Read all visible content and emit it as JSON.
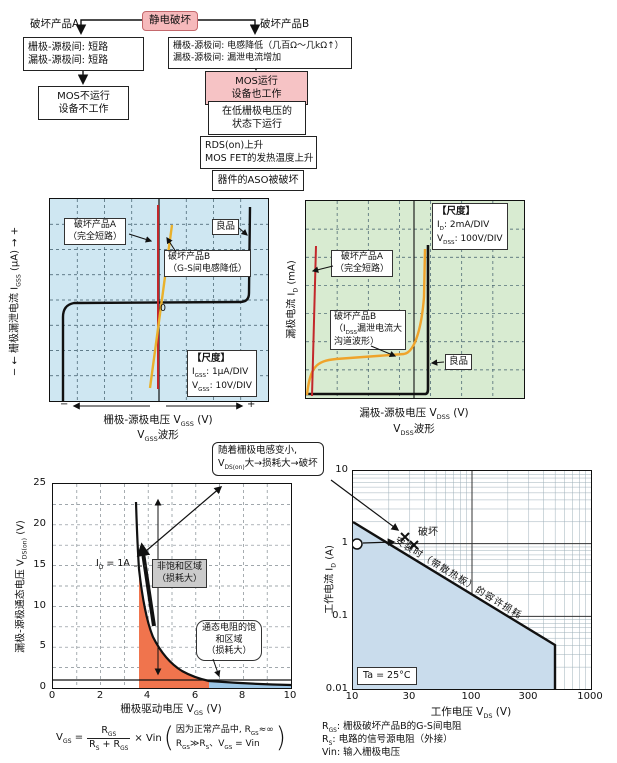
{
  "flowchart": {
    "trigger": "静电破坏",
    "branch_a": {
      "label": "破坏产品A",
      "box1": [
        "栅极-源极间: 短路",
        "漏极-源极间: 短路"
      ],
      "box2": [
        "MOS不运行",
        "设备不工作"
      ]
    },
    "branch_b": {
      "label": "破坏产品B",
      "box1": [
        "栅极-源极间: 电感降低（几百Ω～几kΩ↑）",
        "漏极-源极间: 漏泄电流增加"
      ],
      "box2": [
        "MOS运行",
        "设备也工作"
      ],
      "box3": [
        "在低栅极电压的",
        "状态下运行"
      ],
      "box4": [
        "RDS(on)上升",
        "MOS FET的发热温度上升"
      ],
      "box5": "器件的ASO被破坏"
    }
  },
  "gate_chart": {
    "y_label": {
      "minus": "− ←",
      "pre": "  栅极漏泄电流 I",
      "sub": "GSS",
      "unit": " (μA)  ",
      "plus": "→ +"
    },
    "x_label": {
      "pre": "栅极-源极电压 V",
      "sub": "GSS",
      "unit": " (V)"
    },
    "x_minus": "−",
    "x_plus": "+",
    "waveform": {
      "pre": "V",
      "sub": "GSS",
      "suffix": "波形"
    },
    "zero": "0",
    "product_a": [
      "破坏产品A",
      "（完全短路）"
    ],
    "product_b": [
      "破坏产品B",
      "（G-S间电感降低）"
    ],
    "good": "良品",
    "scale": {
      "title": "【尺度】",
      "r1a": "I",
      "r1s": "GSS",
      "r1b": ": 1μA/DIV",
      "r2a": "V",
      "r2s": "GSS",
      "r2b": ": 10V/DIV"
    }
  },
  "drain_chart": {
    "y_label": {
      "pre": "漏极电流 I",
      "sub": "D",
      "unit": " (mA)"
    },
    "x_label": {
      "pre": "漏极-源极电压 V",
      "sub": "DSS",
      "unit": " (V)"
    },
    "waveform": {
      "pre": "V",
      "sub": "DSS",
      "suffix": "波形"
    },
    "product_a": [
      "破坏产品A",
      "（完全短路）"
    ],
    "product_b": {
      "l1": "破坏产品B",
      "l2a": "（I",
      "l2s": "DSS",
      "l2b": "漏泄电流大",
      "l3": "沟道波形）"
    },
    "good": "良品",
    "scale": {
      "title": "【尺度】",
      "r1a": "I",
      "r1s": "D",
      "r1b": ": 2mA/DIV",
      "r2a": "V",
      "r2s": "DSS",
      "r2b": ": 100V/DIV"
    }
  },
  "vds_chart": {
    "y_ticks": [
      "0",
      "5",
      "10",
      "15",
      "20",
      "25"
    ],
    "x_ticks": [
      "0",
      "2",
      "4",
      "6",
      "8",
      "10"
    ],
    "y_label": {
      "pre": "漏极-源极通态电压 V",
      "sub": "DS(on)",
      "unit": " (V)"
    },
    "x_label": {
      "pre": "栅极驱动电压 V",
      "sub": "GS",
      "unit": " (V)"
    },
    "id_label": {
      "a": "I",
      "s": "D",
      "b": " = 1A"
    },
    "region_unsat": [
      "非饱和区域",
      "（损耗大）"
    ],
    "region_sat": [
      "通态电阻的饱",
      "和区域",
      "（损耗大）"
    ],
    "callout": {
      "l1": "随着栅极电感变小,",
      "l2a": "V",
      "l2s": "DS(on)",
      "l2b": "大→损耗大→破坏"
    },
    "formula": {
      "lhs_a": "V",
      "lhs_s": "GS",
      "eq": " = ",
      "num_a": "R",
      "num_s": "GS",
      "den_a": "R",
      "den_s": "S",
      "den_b": " + R",
      "den_s2": "GS",
      "rhs": "× Vin",
      "paren_open": "(",
      "note1a": "因为正常产品中, R",
      "note1s": "GS",
      "note1b": "≈∞",
      "note2a": "R",
      "note2s": "GS",
      "note2b": "≫R",
      "note2s2": "S",
      "note2c": "、V",
      "note2s3": "GS",
      "note2d": " = Vin",
      "paren_close": ")"
    }
  },
  "soa_chart": {
    "y_ticks": [
      "10",
      "1",
      "0.1",
      "0.01"
    ],
    "x_ticks": [
      "10",
      "30",
      "100",
      "300",
      "1000"
    ],
    "y_label": {
      "pre": "工作电流 I",
      "sub": "D",
      "unit": " (A)"
    },
    "x_label": {
      "pre": "工作电压 V",
      "sub": "DS",
      "unit": " (V)"
    },
    "diag_label": "安装时（带散热板）的容许损耗",
    "break_label": "破坏",
    "ta_label": "Ta = 25°C",
    "legend": [
      {
        "a": "R",
        "s": "GS",
        "b": ": 栅极破坏产品B的G-S间电阻"
      },
      {
        "a": "R",
        "s": "S",
        "b": ": 电路的信号源电阻（外接）"
      },
      {
        "a": "Vin",
        "s": "",
        "b": ": 输入栅极电压"
      }
    ]
  },
  "colors": {
    "scope_blue_bg": "#cfe7f2",
    "scope_green_bg": "#d8ebd1",
    "trace_red": "#c3272b",
    "trace_orange": "#e9b12c",
    "region_salmon": "#f0744d",
    "region_lightblue": "#9cc6e6",
    "soa_fill": "#c9dcec",
    "pink_box": "#f6c3c5"
  },
  "chart_data": [
    {
      "type": "line",
      "title": "VGSS波形（栅极漏泄电流-栅极源极电压特性）",
      "xlabel": "栅极-源极电压 VGSS (V)",
      "ylabel": "栅极漏泄电流 IGSS (μA)",
      "x_scale": "10V/DIV",
      "y_scale": "1μA/DIV",
      "series": [
        {
          "name": "良品",
          "points": [
            [
              -33,
              -7
            ],
            [
              -32,
              -0.3
            ],
            [
              0,
              0.1
            ],
            [
              33,
              0.4
            ],
            [
              34,
              7
            ]
          ]
        },
        {
          "name": "破坏产品A（完全短路）",
          "points": [
            [
              0,
              -6.5
            ],
            [
              0,
              7
            ]
          ]
        },
        {
          "name": "破坏产品B（G-S间电感降低）",
          "points": [
            [
              -3,
              -6.5
            ],
            [
              5,
              6.5
            ]
          ]
        }
      ]
    },
    {
      "type": "line",
      "title": "VDSS波形（漏极电流-漏极源极电压特性）",
      "xlabel": "漏极-源极电压 VDSS (V)",
      "ylabel": "漏极电流 ID (mA)",
      "x_scale": "100V/DIV",
      "y_scale": "2mA/DIV",
      "series": [
        {
          "name": "良品",
          "points": [
            [
              0,
              0
            ],
            [
              390,
              0
            ],
            [
              395,
              10
            ]
          ]
        },
        {
          "name": "破坏产品A（完全短路）",
          "points": [
            [
              3,
              0
            ],
            [
              12,
              10
            ]
          ]
        },
        {
          "name": "破坏产品B（IDSS漏泄电流大 沟道波形）",
          "points": [
            [
              0,
              0
            ],
            [
              30,
              2.4
            ],
            [
              330,
              2.7
            ],
            [
              380,
              6
            ],
            [
              392,
              9.8
            ]
          ]
        }
      ]
    },
    {
      "type": "line",
      "title": "VDS(on)-VGS特性 (ID = 1A)",
      "xlabel": "栅极驱动电压 VGS (V)",
      "ylabel": "漏极-源极通态电压 VDS(on) (V)",
      "xlim": [
        0,
        10
      ],
      "ylim": [
        0,
        25
      ],
      "baseline": 1,
      "series": [
        {
          "name": "ID = 1A",
          "points": [
            [
              3.7,
              25
            ],
            [
              3.9,
              20
            ],
            [
              4.0,
              16
            ],
            [
              4.3,
              10
            ],
            [
              4.6,
              7
            ],
            [
              5,
              4.5
            ],
            [
              5.5,
              3
            ],
            [
              6,
              2.2
            ],
            [
              6.6,
              1.6
            ],
            [
              7,
              1.4
            ],
            [
              8,
              1.15
            ],
            [
              9,
              1.05
            ],
            [
              10,
              1.0
            ]
          ]
        }
      ],
      "regions": [
        {
          "label": "非饱和区域（损耗大）",
          "x_range": [
            3.7,
            6.6
          ],
          "color": "#f0744d"
        },
        {
          "label": "通态电阻的饱和区域（损耗大）",
          "x_range": [
            6.6,
            10
          ],
          "color": "#9cc6e6"
        }
      ]
    },
    {
      "type": "line",
      "title": "安装时（带散热板）的容许损耗 (SOA)",
      "xlabel": "工作电压 VDS (V)",
      "ylabel": "工作电流 ID (A)",
      "x_scale_type": "log",
      "y_scale_type": "log",
      "xlim": [
        10,
        1000
      ],
      "ylim": [
        0.01,
        10
      ],
      "note": "Ta = 25°C",
      "series": [
        {
          "name": "容许损耗边界",
          "points": [
            [
              10,
              2
            ],
            [
              500,
              0.04
            ],
            [
              500,
              0.01
            ]
          ]
        }
      ],
      "markers": [
        {
          "label": "工作点",
          "symbol": "circle",
          "points": [
            [
              10,
              1
            ]
          ]
        },
        {
          "label": "破坏",
          "symbol": "x",
          "points": [
            [
              28,
              1.2
            ],
            [
              33,
              0.95
            ]
          ]
        }
      ]
    }
  ]
}
